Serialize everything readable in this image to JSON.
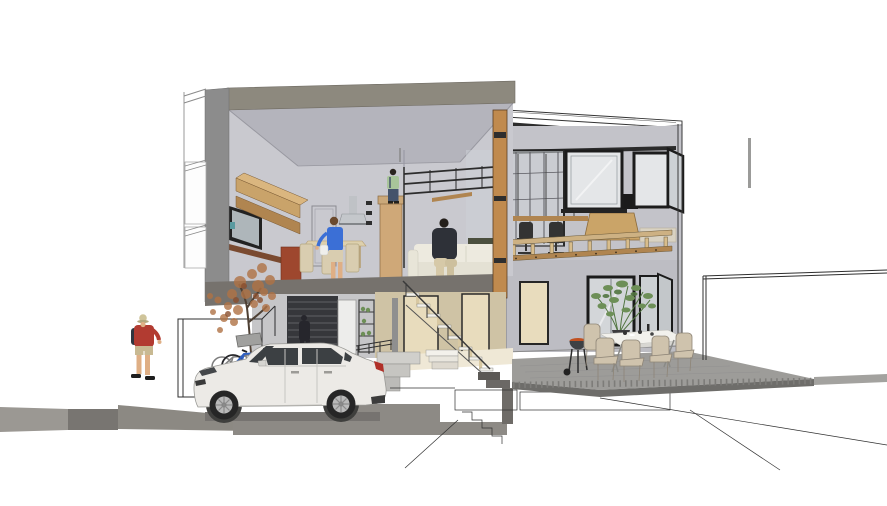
{
  "meta": {
    "type": "architectural-section-perspective",
    "description": "Cutaway section render of a modern two-storey house: first-floor kitchen/living with mezzanine loft, glass-fronted study wing, ground-floor carport with white SUV and bicycles, outdoor dining deck with barbecue, and surrounding wireframe site lines"
  },
  "colors": {
    "bg": "#ffffff",
    "roofCut": "#8d897e",
    "wallCut": "#8c8c8c",
    "slabCut": "#76726d",
    "interiorWall": "#c9c9cf",
    "ceiling": "#b4b4bc",
    "woodLight": "#c9a36a",
    "woodTop": "#dab67f",
    "woodMid": "#b08550",
    "woodPost": "#c08a4e",
    "mezzTan": "#cfa878",
    "tanWall": "#cfc3a5",
    "doorBeige": "#e8dcbd",
    "doorWhite": "#ededeb",
    "frameDark": "#1f1f1f",
    "glass": "#d0d4d8",
    "glassBright": "#e4e6e8",
    "rightWallUpper": "#c3c3c9",
    "rightWallLower": "#bdbdc3",
    "beamDark": "#2d2d2d",
    "railTan": "#cdb183",
    "deckTop": "#9d9c99",
    "deckFace": "#6e6d6a",
    "deckFar": "#a3a29f",
    "groundLight": "#9b9893",
    "groundMid": "#787571",
    "groundDark": "#8c8983",
    "pillar": "#6e6b67",
    "louver": "#36373b",
    "floorCream": "#efe8d6",
    "carBody": "#eceae6",
    "carWindow": "#3c4043",
    "tire": "#262626",
    "alloy": "#b9b9b9",
    "tailLight": "#b03028",
    "redShirt": "#b23b31",
    "khaki": "#c8b992",
    "skin": "#dfaf85",
    "hat": "#cfc49a",
    "backpack": "#30353f",
    "blueShirt": "#3b6fd6",
    "skirt": "#d9cdb0",
    "darkFigure": "#26262c",
    "greenShirt": "#a8c49a",
    "jeans": "#44536b",
    "sofa": "#edeadf",
    "sofaSeat": "#e4e1d4",
    "olive": "#4b4f3e",
    "pants": "#d6c9a8",
    "hood": "#bfc2c6",
    "redCabinet": "#9e472e",
    "shelfWood": "#7a4a30",
    "chairTan": "#cfc3ad",
    "tableWhite": "#f2f1ec",
    "grill": "#3e4144",
    "coal": "#c05020",
    "plant": "#6d8f57",
    "plantDark": "#517540",
    "autumn": "#b07245",
    "autumnDark": "#8a4f2e",
    "trunk": "#4e4034",
    "bikeBlue": "#2f5fc0",
    "bikeGray": "#7d7d7d",
    "wire": "#303030",
    "teal": "#5a9aa0"
  },
  "scene": {
    "building": {
      "storeys": [
        "ground floor: carport, louvred wall, entry hall, staircase",
        "first floor: kitchen with wood cabinets, dining table, cream sofa",
        "mezzanine loft above kitchen"
      ],
      "right_wing": "glass-fronted wing with hanging desk, office chairs and bedroom",
      "terrace": "raised grey outdoor deck with dining set and kettle barbecue"
    },
    "people": [
      {
        "id": "pedestrian",
        "appearance": "man walking at far left: red t-shirt, khaki shorts, dark backpack, beige hat"
      },
      {
        "id": "carport-figure",
        "appearance": "dark silhouette standing behind the car"
      },
      {
        "id": "kitchen-figure",
        "appearance": "woman in blue top at the kitchen"
      },
      {
        "id": "sofa-figure",
        "appearance": "person in dark sweater seated on the cream sofa"
      },
      {
        "id": "mezzanine-figure",
        "appearance": "person in pale green top standing on the mezzanine"
      }
    ],
    "vehicles": [
      {
        "id": "suv",
        "appearance": "white compact SUV parked in the carport, facing left"
      }
    ],
    "objects": [
      "two bicycles behind the car",
      "autumn tree in the carport",
      "stainless range hood",
      "outdoor dining table with five tan chairs",
      "kettle barbecue with glowing coals",
      "potted green plant",
      "wireframe perimeter fence and basement excavation lines",
      "grey site/ground strips"
    ]
  }
}
